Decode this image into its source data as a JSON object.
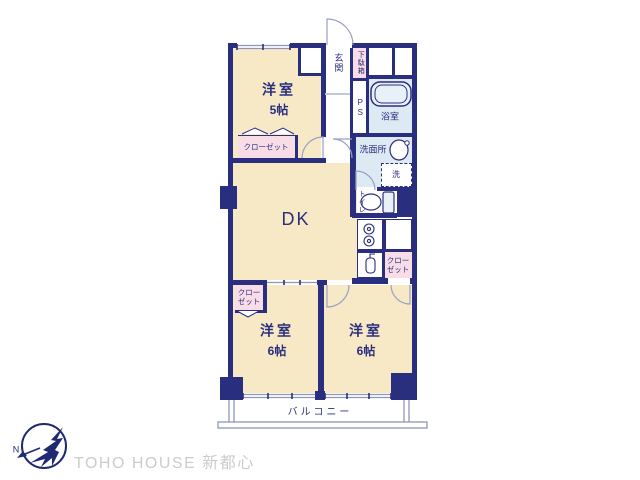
{
  "colors": {
    "navy": "#2a2e7f",
    "cream": "#f8e9c6",
    "pink": "#f9dde6",
    "wet_blue": "#dde9f3",
    "tub_blue": "#e9f1f8",
    "line_gray": "#8f94ba",
    "arc_gray": "#9aa0c4",
    "watermark_gray": "#cccccc",
    "logo_navy": "#1f2a72"
  },
  "rooms": {
    "west5": {
      "label": "洋室",
      "size": "5帖"
    },
    "dk": {
      "label": "DK"
    },
    "west6_left": {
      "label": "洋室",
      "size": "6帖"
    },
    "west6_right": {
      "label": "洋室",
      "size": "6帖"
    }
  },
  "areas": {
    "entrance": "玄関",
    "shoe_cabinet": "下駄箱",
    "pipe_space": "PS",
    "bathroom": "浴室",
    "washroom": "洗面所",
    "laundry": "洗",
    "toilet": "トイレ",
    "balcony": "バルコニー"
  },
  "closets": {
    "bedroom5": "クローゼット",
    "kitchen_side": "クロー\nゼット",
    "bedroom6_side": "クロー\nゼット"
  },
  "logo": {
    "company": "TOHO HOUSE 新都心",
    "north": "N"
  }
}
